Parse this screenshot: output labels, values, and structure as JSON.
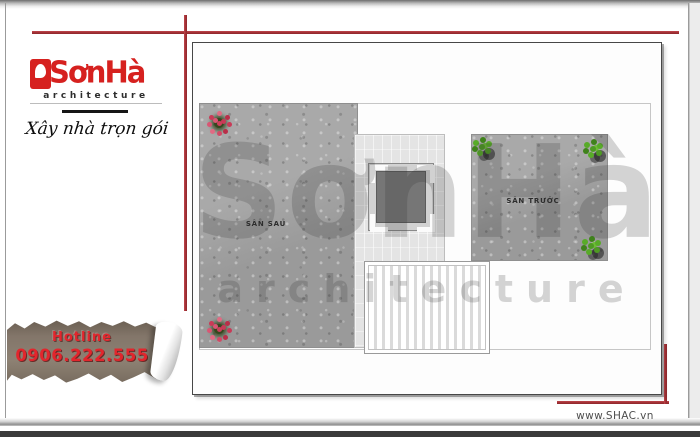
{
  "branding": {
    "logo_text": "SơnHà",
    "logo_sub": "architecture",
    "tagline": "Xây nhà trọn gói"
  },
  "hotline": {
    "label": "Hotline",
    "phone": "0906.222.555"
  },
  "plan": {
    "labels": {
      "back_yard": "SÂN SAU",
      "front_yard": "SÂN TRƯỚC"
    },
    "watermark": {
      "line1": "SơnHà",
      "line2": "architecture"
    }
  },
  "footer": {
    "website": "www.SHAC.vn"
  },
  "colors": {
    "accent_red": "#a53439",
    "logo_red": "#d6211f",
    "hotline_red": "#e2262d",
    "paper_brown": "#827567",
    "concrete_gray": "#a2a2a2"
  }
}
